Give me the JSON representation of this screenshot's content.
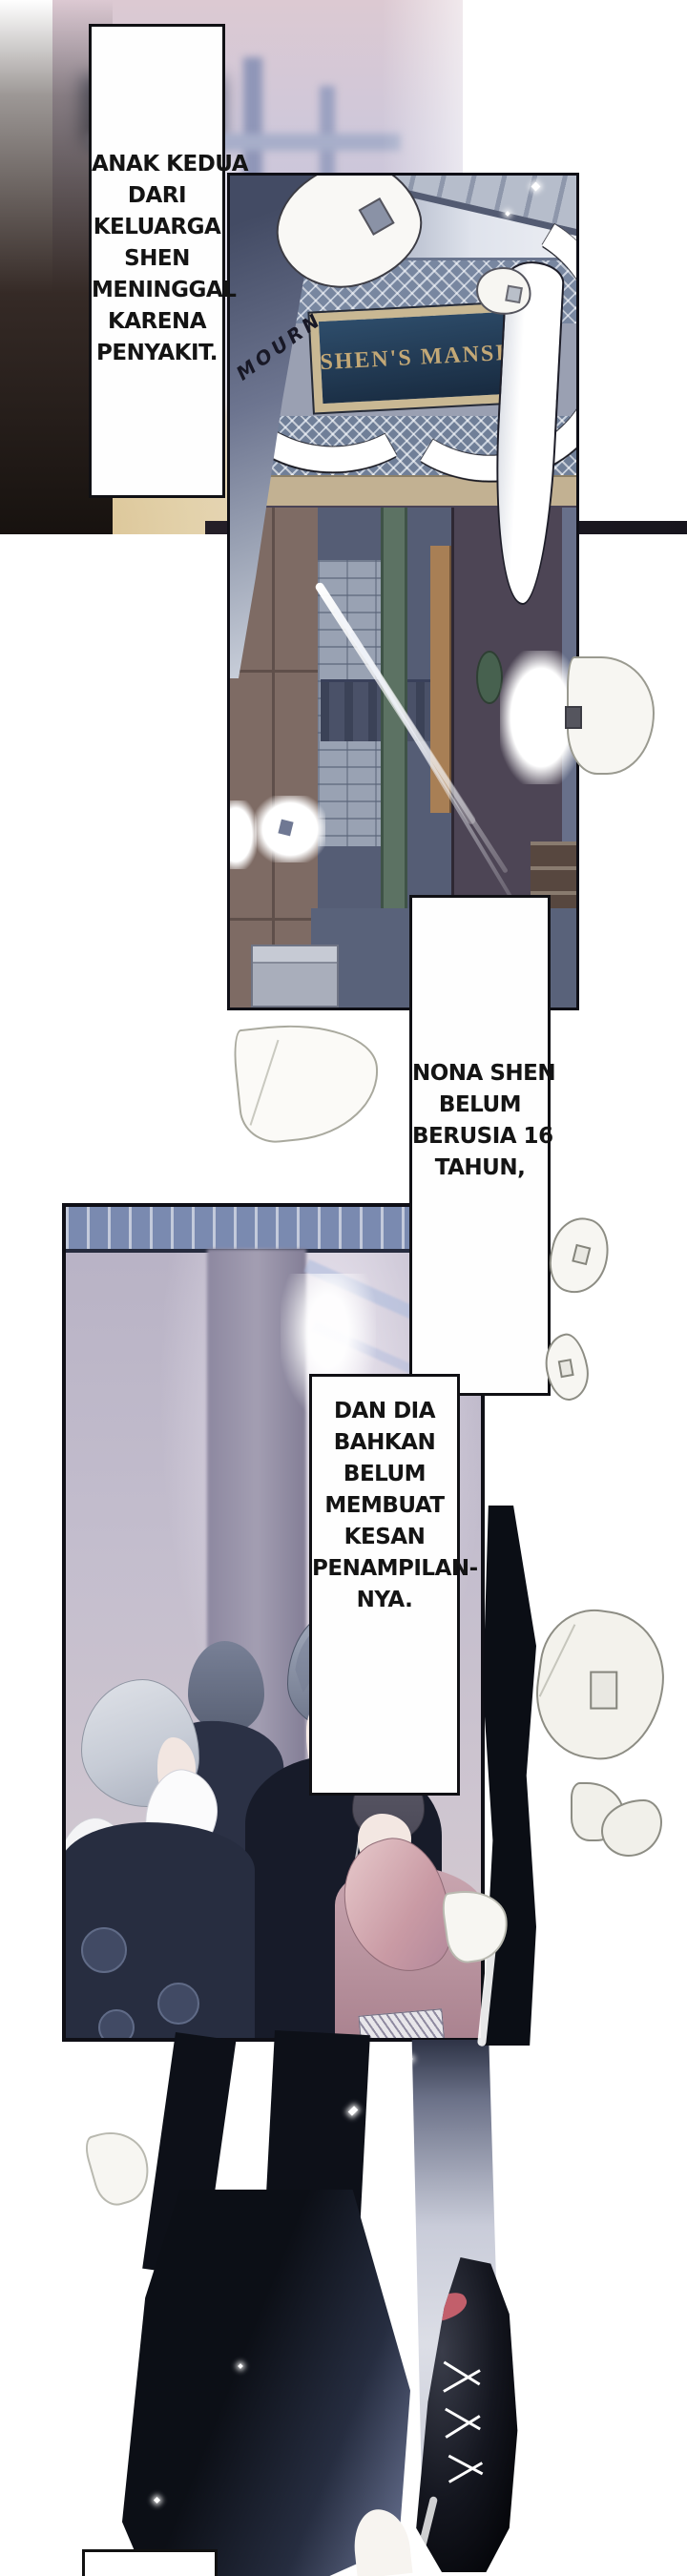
{
  "narration": {
    "box1": {
      "lines": [
        "ANAK KEDUA",
        "DARI",
        "KELUARGA",
        "SHEN",
        "MENINGGAL",
        "KARENA",
        "PENYAKIT."
      ]
    },
    "box2": {
      "lines": [
        "NONA SHEN",
        "BELUM",
        "BERUSIA 16",
        "TAHUN,"
      ]
    },
    "box3": {
      "lines": [
        "DAN DIA",
        "BAHKAN",
        "BELUM",
        "MEMBUAT",
        "KESAN",
        "PENAMPILAN-",
        "NYA."
      ]
    }
  },
  "panel1": {
    "sign_text": "SHEN'S MANSION",
    "sfx_mourn": "MOURN"
  },
  "colors": {
    "page_bg": "#ffffff",
    "panel_border": "#0f0f16",
    "box_border": "#101014",
    "narration_text": "#141414",
    "sign_board": "#24435f",
    "sign_frame": "#c9b893",
    "sign_letters": "#c3a876",
    "gray_drape": "#4b5369",
    "white_drape": "#ffffff",
    "people_bg_lavender": "#bcb5c7",
    "mourning_robe_dark": "#171b29",
    "mauve_robe": "#c9a6b0",
    "bottom_lavender": "#cfc8da",
    "floor_beige": "#d9c08f",
    "boot_black": "#0c0e15",
    "boot_lining_red": "#c25f6b"
  }
}
